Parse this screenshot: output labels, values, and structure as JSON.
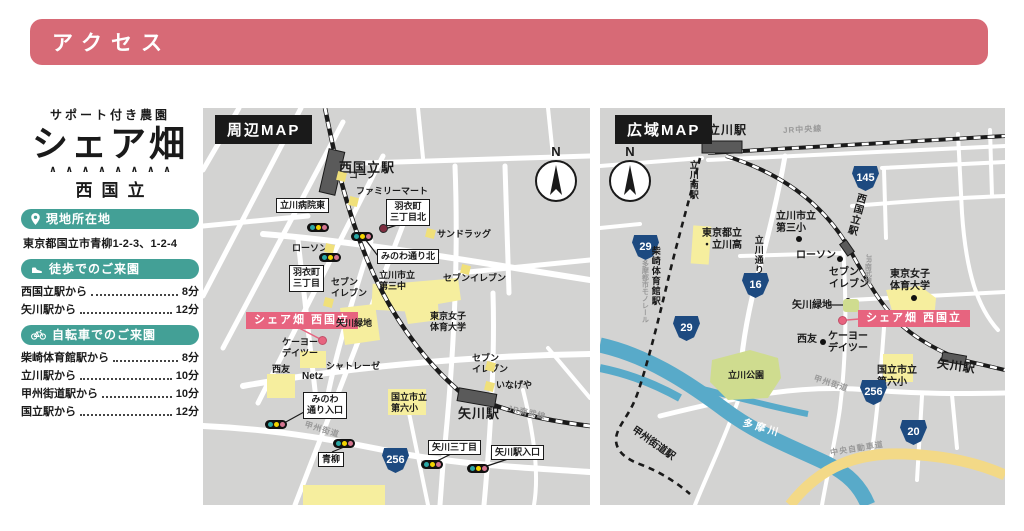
{
  "header": {
    "title": "アクセス"
  },
  "sidebar": {
    "farm_type": "サポート付き農園",
    "brand": "シェア畑",
    "decoration": "∧∧∧∧∧∧∧∧",
    "location": "西国立",
    "address_section": {
      "icon": "pin-icon",
      "title": "現地所在地",
      "address": "東京都国立市青柳1-2-3、1-2-4"
    },
    "walk_section": {
      "icon": "shoe-icon",
      "title": "徒歩でのご来園",
      "routes": [
        {
          "from": "西国立駅から",
          "time": "8分"
        },
        {
          "from": "矢川駅から",
          "time": "12分"
        }
      ]
    },
    "bicycle_section": {
      "icon": "bicycle-icon",
      "title": "自転車でのご来園",
      "routes": [
        {
          "from": "柴崎体育館駅から",
          "time": "8分"
        },
        {
          "from": "立川駅から",
          "time": "10分"
        },
        {
          "from": "甲州街道駅から",
          "time": "10分"
        },
        {
          "from": "国立駅から",
          "time": "12分"
        }
      ]
    }
  },
  "colors": {
    "header_pink": "#d76a76",
    "teal": "#43a096",
    "badge_pink": "#e7647f",
    "map_bg": "#d3d3d2",
    "building_yellow": "#f6ee9e",
    "park_green": "#cfdc8f",
    "river_blue": "#58aac9",
    "highway_tan": "#f3d987",
    "shield_navy": "#1d4a80"
  },
  "maps": {
    "local": {
      "title": "周辺MAP",
      "compass": "N",
      "labels": [
        {
          "t": "station",
          "x": 136,
          "y": 52,
          "text": "西国立駅",
          "name": "station-nishikunitachi"
        },
        {
          "t": "marker",
          "x": 134,
          "y": 64,
          "name": "coop-marker"
        },
        {
          "t": "plain",
          "x": 146,
          "y": 62,
          "text": "コープ",
          "name": "poi-coop"
        },
        {
          "t": "marker",
          "x": 146,
          "y": 89,
          "name": "familymart-marker"
        },
        {
          "t": "plain",
          "x": 153,
          "y": 78,
          "text": "ファミリーマート",
          "name": "poi-familymart"
        },
        {
          "t": "box",
          "x": 73,
          "y": 90,
          "text": "立川病院東",
          "name": "intersection-tachikawa-hospital-east"
        },
        {
          "t": "plain",
          "x": 89,
          "y": 135,
          "text": "ローソン",
          "name": "poi-lawson"
        },
        {
          "t": "marker",
          "x": 122,
          "y": 136,
          "name": "lawson-marker"
        },
        {
          "t": "box",
          "x": 183,
          "y": 91,
          "text": "羽衣町\n三丁目北",
          "name": "intersection-hagoromo-3-north"
        },
        {
          "t": "reddot",
          "x": 176,
          "y": 116,
          "name": "hagoromo-north-dot"
        },
        {
          "t": "marker",
          "x": 223,
          "y": 121,
          "name": "sundrug-marker"
        },
        {
          "t": "plain",
          "x": 234,
          "y": 121,
          "text": "サンドラッグ",
          "name": "poi-sundrug"
        },
        {
          "t": "box",
          "x": 174,
          "y": 141,
          "text": "みのわ通り北",
          "name": "intersection-minowa-street-north"
        },
        {
          "t": "plain",
          "x": 176,
          "y": 162,
          "text": "立川市立\n第三中",
          "name": "poi-daisan-junior-high"
        },
        {
          "t": "plain",
          "x": 128,
          "y": 169,
          "text": "セブン\nイレブン",
          "name": "poi-seveneleven-1"
        },
        {
          "t": "marker",
          "x": 121,
          "y": 190,
          "name": "seveneleven-1-marker"
        },
        {
          "t": "box",
          "x": 86,
          "y": 157,
          "text": "羽衣町\n三丁目",
          "name": "intersection-hagoromo-3"
        },
        {
          "t": "pink",
          "x": 43,
          "y": 204,
          "text": "シェア畑 西国立",
          "name": "sharebatake-badge"
        },
        {
          "t": "pinkdot",
          "x": 115,
          "y": 228,
          "name": "sharebatake-dot"
        },
        {
          "t": "plain",
          "x": 133,
          "y": 210,
          "text": "矢川緑地",
          "name": "poi-yagawa-ryokuchi"
        },
        {
          "t": "plain",
          "x": 227,
          "y": 203,
          "text": "東京女子\n体育大学",
          "name": "poi-tokyo-womens-college"
        },
        {
          "t": "marker",
          "x": 258,
          "y": 157,
          "name": "seveneleven-2-marker"
        },
        {
          "t": "plain",
          "x": 240,
          "y": 165,
          "text": "セブンイレブン",
          "name": "poi-seveneleven-2"
        },
        {
          "t": "plain",
          "x": 79,
          "y": 229,
          "text": "ケーヨー\nデイツー",
          "name": "poi-keiyo-d2"
        },
        {
          "t": "plain",
          "x": 69,
          "y": 256,
          "text": "西友",
          "name": "poi-seiyu"
        },
        {
          "t": "plain",
          "x": 99,
          "y": 263,
          "text": "Netz",
          "fs": 10,
          "name": "poi-netz"
        },
        {
          "t": "plain",
          "x": 123,
          "y": 253,
          "text": "シャトレーゼ",
          "name": "poi-chateraise"
        },
        {
          "t": "box",
          "x": 100,
          "y": 284,
          "text": "みのわ\n通り入口",
          "name": "intersection-minowa-entrance"
        },
        {
          "t": "plain",
          "x": 188,
          "y": 284,
          "text": "国立市立\n第六小",
          "name": "poi-dairoku-elementary"
        },
        {
          "t": "station",
          "x": 255,
          "y": 298,
          "text": "矢川駅",
          "name": "station-yagawa"
        },
        {
          "t": "gray",
          "x": 304,
          "y": 300,
          "text": "JR南武線",
          "rot": 13,
          "name": "jr-nambu-line-label"
        },
        {
          "t": "gray",
          "x": 101,
          "y": 317,
          "text": "甲州街道",
          "rot": 17,
          "name": "koshu-kaido-label"
        },
        {
          "t": "box",
          "x": 115,
          "y": 344,
          "text": "青柳",
          "name": "intersection-aoyagi"
        },
        {
          "t": "shield",
          "x": 179,
          "y": 340,
          "text": "256",
          "name": "route-shield-256"
        },
        {
          "t": "box",
          "x": 225,
          "y": 332,
          "text": "矢川三丁目",
          "name": "intersection-yagawa-3"
        },
        {
          "t": "box",
          "x": 288,
          "y": 337,
          "text": "矢川駅入口",
          "name": "intersection-yagawa-station-entrance"
        },
        {
          "t": "marker",
          "x": 282,
          "y": 274,
          "name": "inageya-marker"
        },
        {
          "t": "plain",
          "x": 293,
          "y": 272,
          "text": "いなげや",
          "name": "poi-inageya"
        },
        {
          "t": "plain",
          "x": 269,
          "y": 245,
          "text": "セブン\nイレブン",
          "name": "poi-seveneleven-3"
        },
        {
          "t": "marker",
          "x": 283,
          "y": 254,
          "name": "seveneleven-3-marker"
        },
        {
          "t": "signal",
          "x": 104,
          "y": 115,
          "name": "traffic-signal"
        },
        {
          "t": "signal",
          "x": 148,
          "y": 124,
          "name": "traffic-signal"
        },
        {
          "t": "signal",
          "x": 116,
          "y": 145,
          "name": "traffic-signal"
        },
        {
          "t": "signal",
          "x": 62,
          "y": 312,
          "name": "traffic-signal"
        },
        {
          "t": "signal",
          "x": 130,
          "y": 331,
          "name": "traffic-signal"
        },
        {
          "t": "signal",
          "x": 218,
          "y": 352,
          "name": "traffic-signal"
        },
        {
          "t": "signal",
          "x": 264,
          "y": 356,
          "name": "traffic-signal"
        }
      ]
    },
    "wide": {
      "title": "広域MAP",
      "compass": "N",
      "labels": [
        {
          "t": "station",
          "x": 108,
          "y": 15,
          "text": "立川駅",
          "fs": 12,
          "name": "station-tachikawa"
        },
        {
          "t": "gray",
          "x": 183,
          "y": 17,
          "text": "JR中央線",
          "rot": -3,
          "name": "jr-chuo-line-label"
        },
        {
          "t": "vertical",
          "x": 88,
          "y": 52,
          "text": "立川南駅",
          "fs": 9,
          "name": "station-tachikawa-minami"
        },
        {
          "t": "shield",
          "x": 252,
          "y": 58,
          "text": "145",
          "name": "route-shield-145"
        },
        {
          "t": "vertical",
          "x": 249,
          "y": 84,
          "text": "西国立駅",
          "rot": 15,
          "name": "station-nishikunitachi-wide"
        },
        {
          "t": "vgray",
          "x": 263,
          "y": 146,
          "text": "JR南武線",
          "name": "jr-nambu-line-label-wide"
        },
        {
          "t": "plain",
          "x": 102,
          "y": 120,
          "text": "東京都立\n・立川高",
          "fs": 10,
          "name": "poi-tachikawa-high"
        },
        {
          "t": "plain",
          "x": 176,
          "y": 103,
          "text": "立川市立\n第三小",
          "fs": 10,
          "name": "poi-daisan-elementary"
        },
        {
          "t": "dot",
          "x": 196,
          "y": 128,
          "name": "daisan-elementary-dot"
        },
        {
          "t": "vertical",
          "x": 153,
          "y": 127,
          "text": "立川通り",
          "fs": 9,
          "name": "tachikawa-dori-label"
        },
        {
          "t": "shield",
          "x": 32,
          "y": 127,
          "text": "29",
          "name": "route-shield-29a"
        },
        {
          "t": "shield",
          "x": 142,
          "y": 165,
          "text": "16",
          "name": "route-shield-16"
        },
        {
          "t": "shield",
          "x": 73,
          "y": 208,
          "text": "29",
          "name": "route-shield-29b"
        },
        {
          "t": "vertical",
          "x": 50,
          "y": 138,
          "text": "柴崎体育館駅",
          "fs": 9,
          "name": "station-shibasaki-taiikukan"
        },
        {
          "t": "vgray",
          "x": 40,
          "y": 152,
          "text": "多摩都市モノレール",
          "name": "tama-monorail-label"
        },
        {
          "t": "plain",
          "x": 196,
          "y": 142,
          "text": "ローソン",
          "fs": 10,
          "name": "poi-lawson-wide"
        },
        {
          "t": "dot",
          "x": 237,
          "y": 148,
          "name": "lawson-dot"
        },
        {
          "t": "plain",
          "x": 229,
          "y": 159,
          "text": "セブン\nイレブン",
          "fs": 10,
          "name": "poi-seveneleven-wide"
        },
        {
          "t": "dot",
          "x": 245,
          "y": 190,
          "name": "seveneleven-dot"
        },
        {
          "t": "plain",
          "x": 192,
          "y": 192,
          "text": "矢川緑地",
          "fs": 10,
          "name": "poi-yagawa-ryokuchi-wide"
        },
        {
          "t": "greenblob",
          "x": 243,
          "y": 191,
          "name": "yagawa-ryokuchi-area"
        },
        {
          "t": "plain",
          "x": 290,
          "y": 161,
          "text": "東京女子\n体育大学",
          "fs": 10,
          "name": "poi-tokyo-womens-college-wide"
        },
        {
          "t": "dot",
          "x": 311,
          "y": 187,
          "name": "college-dot"
        },
        {
          "t": "pink",
          "x": 258,
          "y": 202,
          "text": "シェア畑 西国立",
          "name": "sharebatake-badge-wide"
        },
        {
          "t": "pinkdot",
          "x": 238,
          "y": 208,
          "name": "sharebatake-dot-wide"
        },
        {
          "t": "plain",
          "x": 197,
          "y": 226,
          "text": "西友",
          "fs": 10,
          "name": "poi-seiyu-wide"
        },
        {
          "t": "dot",
          "x": 220,
          "y": 231,
          "name": "seiyu-dot"
        },
        {
          "t": "plain",
          "x": 228,
          "y": 223,
          "text": "ケーヨー\nデイツー",
          "fs": 10,
          "name": "poi-keiyo-d2-wide"
        },
        {
          "t": "plain",
          "x": 277,
          "y": 257,
          "text": "国立市立\n第六小",
          "fs": 10,
          "name": "poi-dairoku-elementary-wide"
        },
        {
          "t": "station",
          "x": 337,
          "y": 251,
          "text": "矢川駅",
          "fs": 12,
          "rot": 8,
          "name": "station-yagawa-wide"
        },
        {
          "t": "gray",
          "x": 213,
          "y": 271,
          "text": "甲州街道",
          "rot": 18,
          "name": "koshu-kaido-label-wide"
        },
        {
          "t": "shield",
          "x": 260,
          "y": 272,
          "text": "256",
          "name": "route-shield-256-wide"
        },
        {
          "t": "shield",
          "x": 300,
          "y": 312,
          "text": "20",
          "name": "route-shield-20"
        },
        {
          "t": "area",
          "x": 128,
          "y": 262,
          "text": "立川公園",
          "name": "tachikawa-park-label"
        },
        {
          "t": "water",
          "x": 142,
          "y": 315,
          "text": "多摩川",
          "rot": 16,
          "name": "tamagawa-label"
        },
        {
          "t": "gray",
          "x": 230,
          "y": 336,
          "text": "中央自動車道",
          "rot": -9,
          "name": "chuo-expressway-label"
        },
        {
          "t": "plain",
          "x": 28,
          "y": 330,
          "text": "甲州街道駅",
          "fs": 10,
          "rot": 35,
          "name": "station-koshukaido"
        }
      ]
    }
  }
}
